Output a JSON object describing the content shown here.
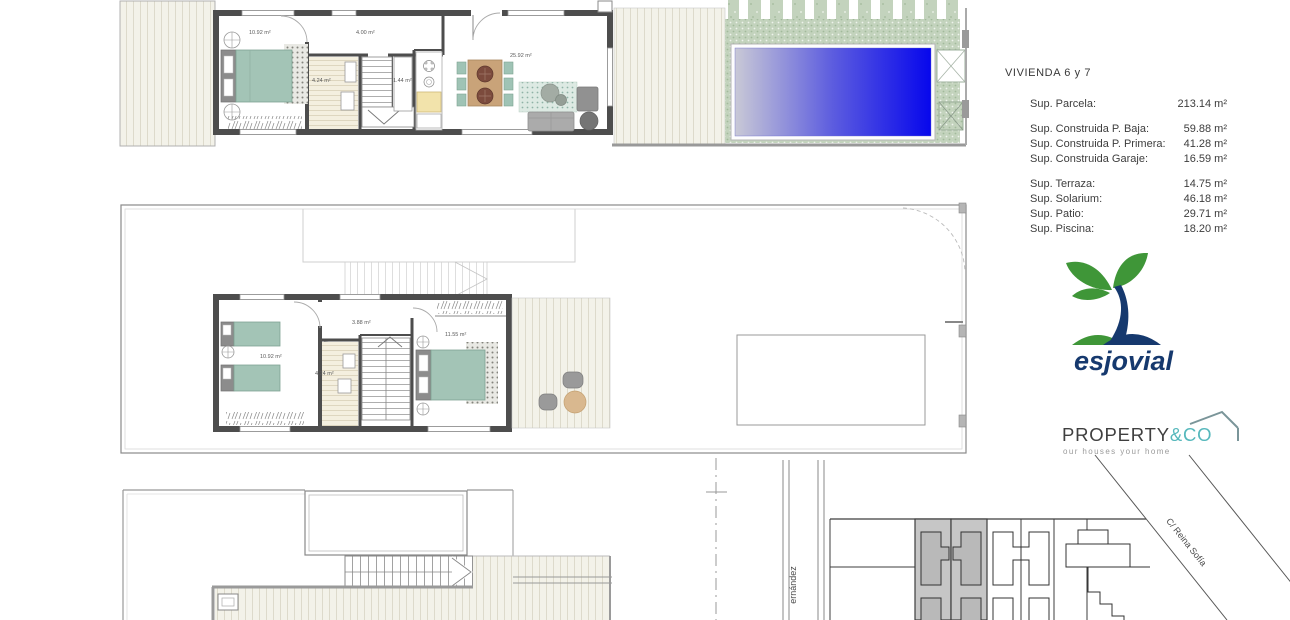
{
  "info_panel": {
    "title": "VIVIENDA  6 y 7",
    "rows": [
      {
        "label": "Sup. Parcela:",
        "value": "213.14 m²"
      },
      {
        "label": "Sup. Construida P. Baja:",
        "value": "59.88 m²"
      },
      {
        "label": "Sup. Construida P. Primera:",
        "value": "41.28 m²"
      },
      {
        "label": "Sup. Construida Garaje:",
        "value": "16.59 m²"
      },
      {
        "label": "Sup. Terraza:",
        "value": "14.75 m²"
      },
      {
        "label": "Sup. Solarium:",
        "value": "46.18 m²"
      },
      {
        "label": "Sup. Patio:",
        "value": "29.71 m²"
      },
      {
        "label": "Sup. Piscina:",
        "value": "18.20 m²"
      }
    ]
  },
  "floor_plans": {
    "ground_floor": {
      "bedroom_area": "10.92 m²",
      "hall_area": "4.00 m²",
      "bathroom_area": "4.24 m²",
      "closet_area": "1.44 m²",
      "living_area": "25.92 m²"
    },
    "first_floor": {
      "twin_bedroom_area": "10.92 m²",
      "hall_area": "3.88 m²",
      "bathroom_area": "4.24 m²",
      "master_bedroom_area": "11.55 m²"
    }
  },
  "site_plan": {
    "street_left": "ernández",
    "street_right": "C/ Reina Sofía"
  },
  "branding": {
    "esjovial": {
      "name": "esjovial"
    },
    "property_co": {
      "name_primary": "PROPERTY",
      "name_accent": "&CO",
      "tagline": "our houses your home"
    }
  },
  "colors": {
    "wall_gray": "#4d4d4d",
    "furniture_teal": "#a3c4b6",
    "grass_green": "#c3d3bd",
    "pool_blue": "#0707ec",
    "logo_green": "#3f9638",
    "logo_navy": "#16396e",
    "property_teal": "#56b8bc"
  }
}
